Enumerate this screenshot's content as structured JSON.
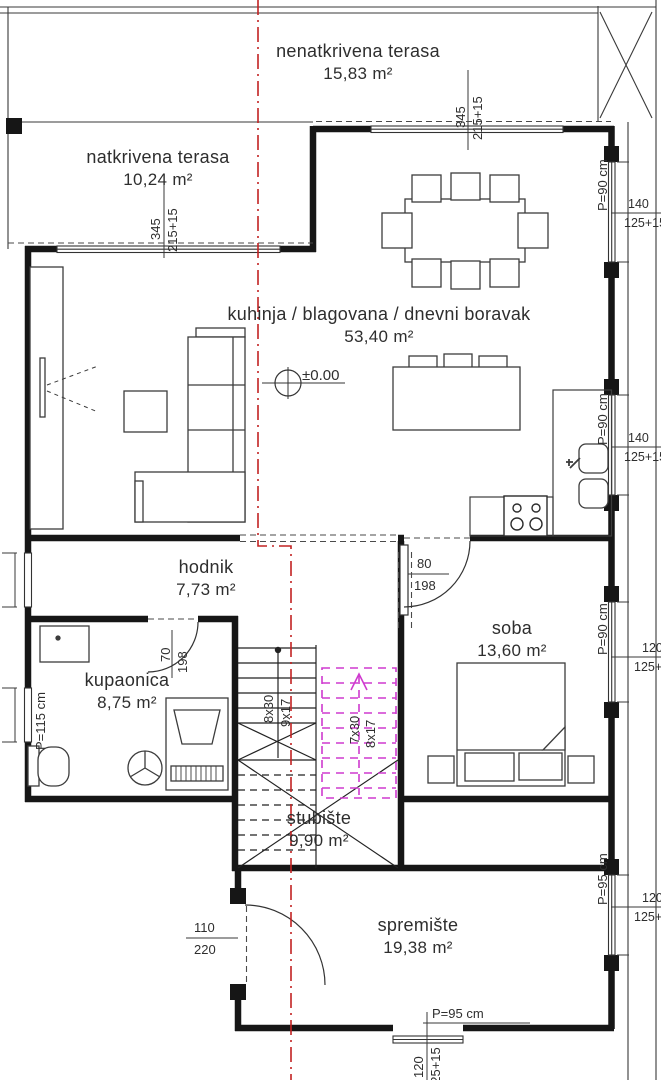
{
  "rooms": {
    "nenatkrivena_terasa": {
      "name": "nenatkrivena terasa",
      "area": "15,83 m²"
    },
    "natkrivena_terasa": {
      "name": "natkrivena terasa",
      "area": "10,24 m²"
    },
    "kuhinja": {
      "name": "kuhinja / blagovana / dnevni boravak",
      "area": "53,40 m²"
    },
    "hodnik": {
      "name": "hodnik",
      "area": "7,73 m²"
    },
    "kupaonica": {
      "name": "kupaonica",
      "area": "8,75 m²"
    },
    "soba": {
      "name": "soba",
      "area": "13,60 m²"
    },
    "stubiste": {
      "name": "stubište",
      "area": "9,90 m²"
    },
    "spremiste": {
      "name": "spremište",
      "area": "19,38 m²"
    }
  },
  "levels": {
    "ground_marker": "±0.00"
  },
  "openings": {
    "window_top_main": {
      "width": "345",
      "height": "215+15"
    },
    "window_terrace": {
      "width": "345",
      "height": "215+15"
    },
    "window_right_living": {
      "width": "140",
      "height": "125+15",
      "parapet": "P=90 cm"
    },
    "window_right_kitchen": {
      "width": "140",
      "height": "125+15",
      "parapet": "P=90 cm"
    },
    "window_right_soba": {
      "width": "120",
      "height": "125+15",
      "parapet": "P=90 cm"
    },
    "window_right_spremiste": {
      "width": "120",
      "height": "125+15",
      "parapet": "P=95 cm"
    },
    "window_bottom_spremiste": {
      "width": "120",
      "height": "125+15",
      "parapet": "P=95 cm"
    },
    "window_left_kupaonica": {
      "parapet": "P=115 cm"
    },
    "door_soba": {
      "width": "80",
      "height": "198"
    },
    "door_kupaonica": {
      "width": "70",
      "height": "198"
    },
    "door_spremiste": {
      "width": "110",
      "height": "220"
    }
  },
  "stairs": {
    "flight_down": {
      "steps": "8x30",
      "rise": "9x17"
    },
    "flight_up": {
      "steps": "7x30",
      "rise": "8x17"
    }
  },
  "colors": {
    "section_line": "#c22222",
    "stairs_above": "#cf3acf",
    "walls": "#161616"
  }
}
